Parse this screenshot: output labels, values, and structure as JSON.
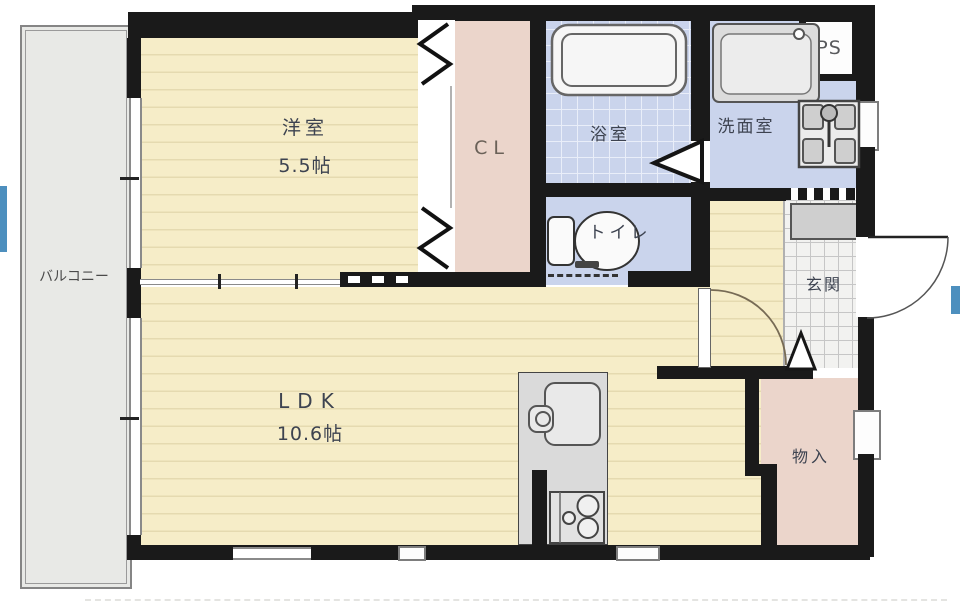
{
  "plan_type": "apartment-floor-plan",
  "labels": {
    "balcony": "バルコニー",
    "western_room": "洋室",
    "western_room_size": "5.5帖",
    "closet": "CL",
    "bathroom": "浴室",
    "washroom": "洗面室",
    "pipe_space": "PS",
    "toilet": "トイレ",
    "entrance": "玄関",
    "living_dining_kitchen": "LDK",
    "living_dining_kitchen_size": "10.6帖",
    "storage": "物入"
  },
  "colors": {
    "wall": "#1a1a1a",
    "flooring": "#f6edc8",
    "flooring-line": "#e5dab0",
    "wet-area": "#cad4ec",
    "tile-line": "#e9eef9",
    "closet-fill": "#ebd5cb",
    "balcony-fill": "#e8e9e6",
    "entrance-tile": "#f2f2f0",
    "entrance-grid": "#c6c6c6",
    "fixture-gray": "#dadada",
    "accent-blue": "#4d8fbe",
    "label-text": "#3d4350"
  }
}
